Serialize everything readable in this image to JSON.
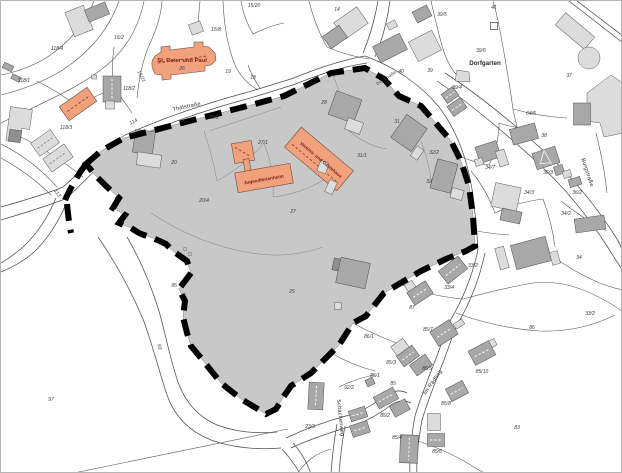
{
  "colors": {
    "zone": "#c8c8c8",
    "boundary": "#000000",
    "building_orange": "#f2a17d",
    "building_dark": "#a8a8a8",
    "building_light": "#dcdcdc",
    "poi_text": "#7e2015"
  },
  "labels": {
    "streets": [
      {
        "t": "Thalstraße",
        "x": 186,
        "y": 107,
        "r": -12
      },
      {
        "t": "Dorfstraße",
        "x": 386,
        "y": 78,
        "r": -33,
        "s": "xs"
      },
      {
        "t": "Burgstraße",
        "x": 585,
        "y": 172,
        "r": 72
      },
      {
        "t": "Im Rädling",
        "x": 433,
        "y": 382,
        "r": -55
      },
      {
        "t": "Schachenweg",
        "x": 338,
        "y": 417,
        "r": 84
      }
    ],
    "places": [
      {
        "t": "Dorfgarten",
        "x": 484,
        "y": 64,
        "r": 0
      }
    ],
    "pois": [
      {
        "t": "St. Peter und Paul",
        "x": 181,
        "y": 61,
        "r": 0
      }
    ],
    "poi_small": [
      {
        "t": "Jugendferienheim",
        "x": 263,
        "y": 180,
        "r": -10
      },
      {
        "t": "Vereins- und Gästehaus",
        "x": 319,
        "y": 160,
        "r": 40
      }
    ],
    "parcels": [
      {
        "t": "15/20",
        "x": 253,
        "y": 6
      },
      {
        "t": "16/2",
        "x": 118,
        "y": 38
      },
      {
        "t": "118/4",
        "x": 56,
        "y": 49
      },
      {
        "t": "118/1",
        "x": 23,
        "y": 81
      },
      {
        "t": "118/2",
        "x": 128,
        "y": 89
      },
      {
        "t": "15/21",
        "x": 139,
        "y": 76,
        "r": 62
      },
      {
        "t": "118/3",
        "x": 65,
        "y": 128
      },
      {
        "t": "15/8",
        "x": 215,
        "y": 30
      },
      {
        "t": "26",
        "x": 181,
        "y": 69
      },
      {
        "t": "19",
        "x": 227,
        "y": 72
      },
      {
        "t": "18",
        "x": 252,
        "y": 78
      },
      {
        "t": "114",
        "x": 133,
        "y": 122,
        "r": -26
      },
      {
        "t": "113",
        "x": 55,
        "y": 193,
        "r": 55
      },
      {
        "t": "14",
        "x": 336,
        "y": 10
      },
      {
        "t": "39/5",
        "x": 441,
        "y": 15
      },
      {
        "t": "41",
        "x": 493,
        "y": 8
      },
      {
        "t": "39/6",
        "x": 480,
        "y": 51
      },
      {
        "t": "37",
        "x": 568,
        "y": 76
      },
      {
        "t": "40",
        "x": 400,
        "y": 72
      },
      {
        "t": "39",
        "x": 429,
        "y": 71
      },
      {
        "t": "39/4",
        "x": 456,
        "y": 88
      },
      {
        "t": "64/5",
        "x": 530,
        "y": 114
      },
      {
        "t": "38",
        "x": 543,
        "y": 136
      },
      {
        "t": "34/7",
        "x": 489,
        "y": 168
      },
      {
        "t": "36/3",
        "x": 547,
        "y": 173
      },
      {
        "t": "36/2",
        "x": 576,
        "y": 193
      },
      {
        "t": "34/3",
        "x": 528,
        "y": 193
      },
      {
        "t": "34/2",
        "x": 565,
        "y": 214
      },
      {
        "t": "34",
        "x": 578,
        "y": 258
      },
      {
        "t": "20/2",
        "x": 213,
        "y": 118
      },
      {
        "t": "20",
        "x": 173,
        "y": 163
      },
      {
        "t": "20/4",
        "x": 203,
        "y": 201
      },
      {
        "t": "27/1",
        "x": 262,
        "y": 143
      },
      {
        "t": "27",
        "x": 292,
        "y": 212
      },
      {
        "t": "28",
        "x": 323,
        "y": 103
      },
      {
        "t": "31",
        "x": 396,
        "y": 122
      },
      {
        "t": "31/1",
        "x": 361,
        "y": 156
      },
      {
        "t": "32/2",
        "x": 433,
        "y": 153
      },
      {
        "t": "32",
        "x": 428,
        "y": 182
      },
      {
        "t": "25",
        "x": 291,
        "y": 292
      },
      {
        "t": "95",
        "x": 173,
        "y": 286
      },
      {
        "t": "93",
        "x": 157,
        "y": 346,
        "r": 80
      },
      {
        "t": "97",
        "x": 50,
        "y": 400
      },
      {
        "t": "23/3",
        "x": 309,
        "y": 427
      },
      {
        "t": "33/2",
        "x": 472,
        "y": 266
      },
      {
        "t": "33/4",
        "x": 448,
        "y": 288
      },
      {
        "t": "87",
        "x": 411,
        "y": 308
      },
      {
        "t": "86",
        "x": 531,
        "y": 328
      },
      {
        "t": "33/2",
        "x": 589,
        "y": 314
      },
      {
        "t": "86/1",
        "x": 368,
        "y": 337
      },
      {
        "t": "85/7",
        "x": 427,
        "y": 330
      },
      {
        "t": "85/3",
        "x": 390,
        "y": 363
      },
      {
        "t": "85/5",
        "x": 426,
        "y": 369
      },
      {
        "t": "85/10",
        "x": 481,
        "y": 372
      },
      {
        "t": "85/1",
        "x": 374,
        "y": 376
      },
      {
        "t": "85",
        "x": 392,
        "y": 384
      },
      {
        "t": "92/2",
        "x": 348,
        "y": 388
      },
      {
        "t": "85/8",
        "x": 445,
        "y": 404
      },
      {
        "t": "85/2",
        "x": 384,
        "y": 416
      },
      {
        "t": "85/4",
        "x": 396,
        "y": 438
      },
      {
        "t": "85/6",
        "x": 436,
        "y": 452
      },
      {
        "t": "83",
        "x": 516,
        "y": 428
      }
    ]
  }
}
